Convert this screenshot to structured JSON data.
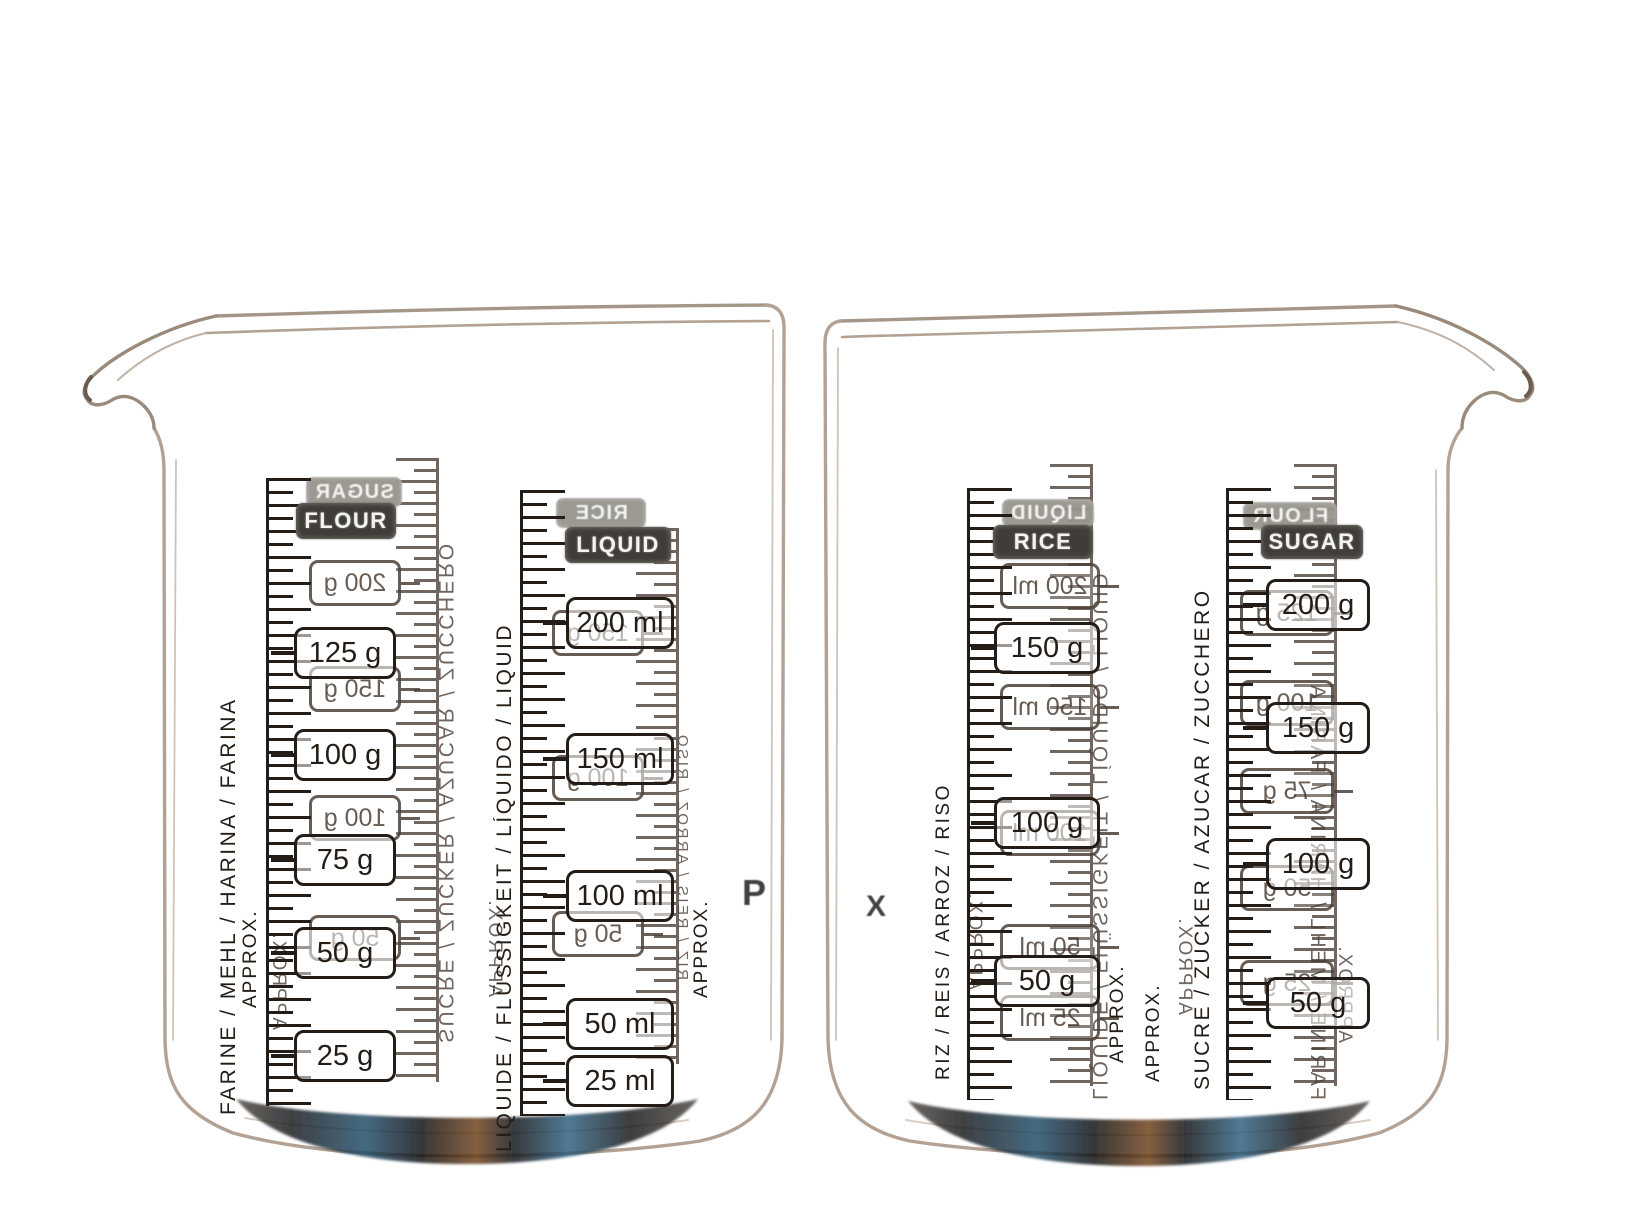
{
  "colors": {
    "background": "#ffffff",
    "print_front": "#241c16",
    "print_back": "#4d4138",
    "badge_front_bg": "#403c37",
    "badge_back_bg": "#97948d",
    "badge_text": "#f4f3ef",
    "glass_line": "#b3a294",
    "bottom_iridescence": [
      "#16181d",
      "#1d4a66",
      "#6b3d12"
    ]
  },
  "beakers": [
    {
      "side": "left",
      "spout": "left",
      "brand_fragment": "P",
      "columns": [
        {
          "front": {
            "badge": "FLOUR",
            "values": [
              "125 g",
              "100 g",
              "75 g",
              "50 g",
              "25 g"
            ],
            "side_text": "FARINE / MEHL / HARINA / FARINA",
            "approx": "APPROX."
          },
          "back": {
            "badge": "SUGAR",
            "values": [
              "200 g",
              "150 g",
              "100 g",
              "50 g"
            ],
            "side_text": "SUCRE / ZUCKER / AZUCAR / ZUCCHERO",
            "approx": "APPROX."
          }
        },
        {
          "front": {
            "badge": "LIQUID",
            "values": [
              "200 ml",
              "150 ml",
              "100 ml",
              "50 ml",
              "25 ml"
            ],
            "side_text": "LIQUIDE / FLÜSSIGKEIT / LÍQUIDO / LIQUID",
            "approx": "APPROX."
          },
          "back": {
            "badge": "RICE",
            "values": [
              "150 g",
              "100 g",
              "50 g"
            ],
            "side_text": "RIZ / REIS / ARROZ / RISO",
            "approx": "APPROX."
          }
        }
      ]
    },
    {
      "side": "right",
      "spout": "right",
      "brand_fragment": "X",
      "columns": [
        {
          "front": {
            "badge": "RICE",
            "values": [
              "150 g",
              "100 g",
              "50 g"
            ],
            "side_text": "RIZ / REIS / ARROZ / RISO",
            "approx": "APPROX."
          },
          "back": {
            "badge": "LIQUID",
            "values": [
              "200 ml",
              "150 ml",
              "100 ml",
              "50 ml",
              "25 ml"
            ],
            "side_text": "LIQUIDE / FLÜSSIGKEIT / LÍQUIDO / LIQUID",
            "approx": "APPROX."
          }
        },
        {
          "front": {
            "badge": "SUGAR",
            "values": [
              "200 g",
              "150 g",
              "100 g",
              "50 g"
            ],
            "side_text": "SUCRE / ZUCKER / AZUCAR / ZUCCHERO",
            "approx": "APPROX."
          },
          "back": {
            "badge": "FLOUR",
            "values": [
              "125 g",
              "100 g",
              "75 g",
              "50 g",
              "25 g"
            ],
            "side_text": "FARINE / MEHL / HARINA / FARINA",
            "approx": "APPROX."
          }
        }
      ]
    }
  ]
}
